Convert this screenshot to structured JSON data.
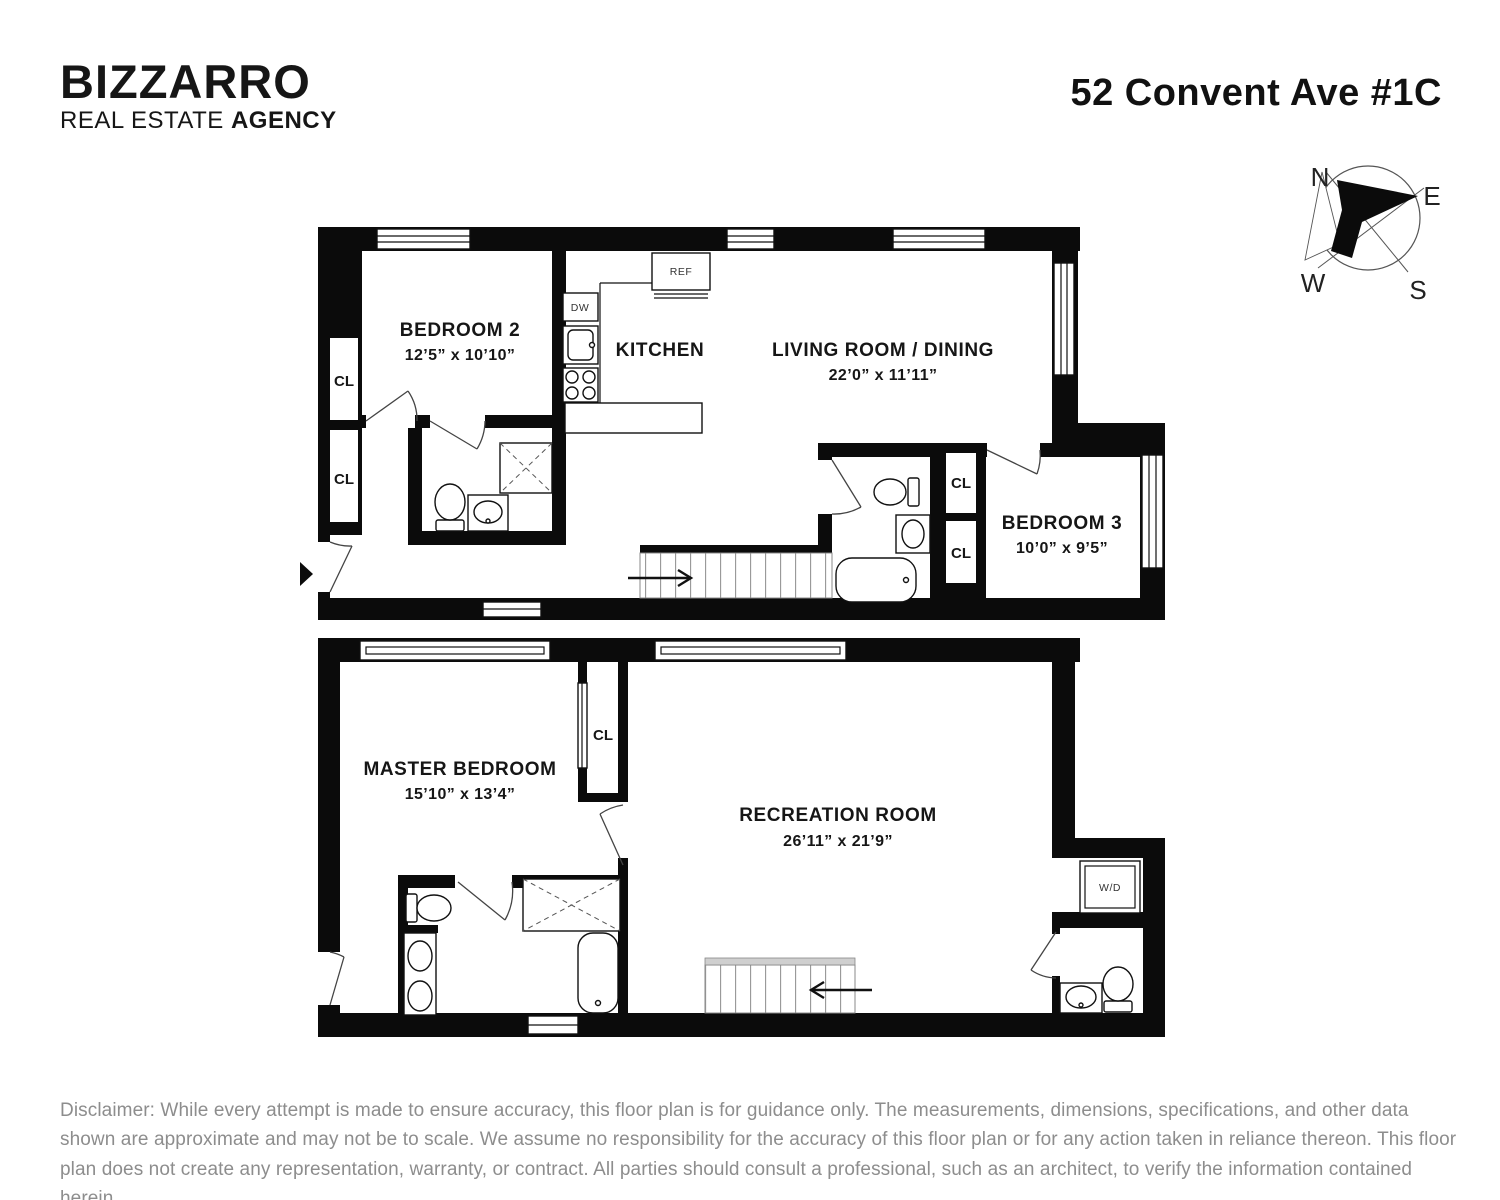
{
  "header": {
    "logo_line1": "BIZZARRO",
    "logo_line2_regular": "REAL ESTATE ",
    "logo_line2_bold": "AGENCY",
    "address": "52 Convent Ave #1C"
  },
  "compass": {
    "n": "N",
    "e": "E",
    "s": "S",
    "w": "W"
  },
  "floor1": {
    "bedroom2": {
      "name": "BEDROOM 2",
      "dims": "12’5” x 10’10”"
    },
    "kitchen": {
      "name": "KITCHEN"
    },
    "living": {
      "name": "LIVING ROOM / DINING",
      "dims": "22’0” x 11’11”"
    },
    "bedroom3": {
      "name": "BEDROOM 3",
      "dims": "10’0” x 9’5”"
    },
    "cl": "CL",
    "ref": "REF",
    "dw": "DW"
  },
  "floor2": {
    "master": {
      "name": "MASTER BEDROOM",
      "dims": "15’10” x 13’4”"
    },
    "rec": {
      "name": "RECREATION ROOM",
      "dims": "26’11” x 21’9”"
    },
    "cl": "CL",
    "wd": "W/D"
  },
  "disclaimer": "Disclaimer: While every attempt is made to ensure accuracy, this floor plan is for guidance only. The measurements, dimensions, specifications, and other data shown are approximate and may not be to scale. We assume no responsibility for the accuracy of this floor plan or for any action taken in reliance thereon. This floor plan does not create any representation, warranty, or contract. All parties should consult a professional, such as an architect, to verify the information contained herein."
}
